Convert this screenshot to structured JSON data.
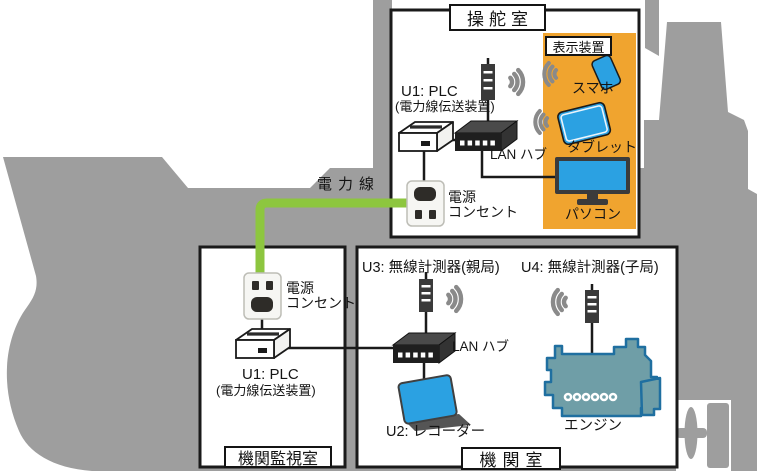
{
  "colors": {
    "ship_gray": "#9e9e9e",
    "panel_orange": "#f0a42f",
    "device_blue": "#2ba1e2",
    "power_line_green": "#8dc63f",
    "engine_teal": "#6f9ea7",
    "engine_outline": "#1f6fa0",
    "line_black": "#1a1a1a"
  },
  "rooms": {
    "bridge": {
      "label": "操舵室"
    },
    "engine_monitoring_room": {
      "label": "機関監視室"
    },
    "engine_room": {
      "label": "機関室"
    }
  },
  "bridge": {
    "plc": {
      "line1": "U1: PLC",
      "line2": "(電力線伝送装置)"
    },
    "lan_hub": {
      "label": "LAN ハブ"
    },
    "outlet": {
      "line1": "電源",
      "line2": "コンセント"
    },
    "display_panel": {
      "label": "表示装置",
      "smartphone": {
        "label": "スマホ"
      },
      "tablet": {
        "label": "タブレット"
      },
      "pc": {
        "label": "パソコン"
      }
    }
  },
  "power_line": {
    "label": "電力線"
  },
  "monitoring_room": {
    "outlet": {
      "line1": "電源",
      "line2": "コンセント"
    },
    "plc": {
      "line1": "U1: PLC",
      "line2": "(電力線伝送装置)"
    }
  },
  "engine_room": {
    "u3": {
      "label": "U3: 無線計測器(親局)"
    },
    "u4": {
      "label": "U4: 無線計測器(子局)"
    },
    "lan_hub": {
      "label": "LAN ハブ"
    },
    "recorder": {
      "label": "U2: レコーダー"
    },
    "engine": {
      "label": "エンジン"
    }
  },
  "icons": [
    "ship-silhouette",
    "antenna-icon",
    "wireless-waves-icon",
    "plc-modem-icon",
    "lan-hub-icon",
    "power-outlet-icon",
    "smartphone-icon",
    "tablet-icon",
    "desktop-pc-icon",
    "recorder-icon",
    "engine-icon",
    "propeller-icon",
    "rudder-icon"
  ]
}
